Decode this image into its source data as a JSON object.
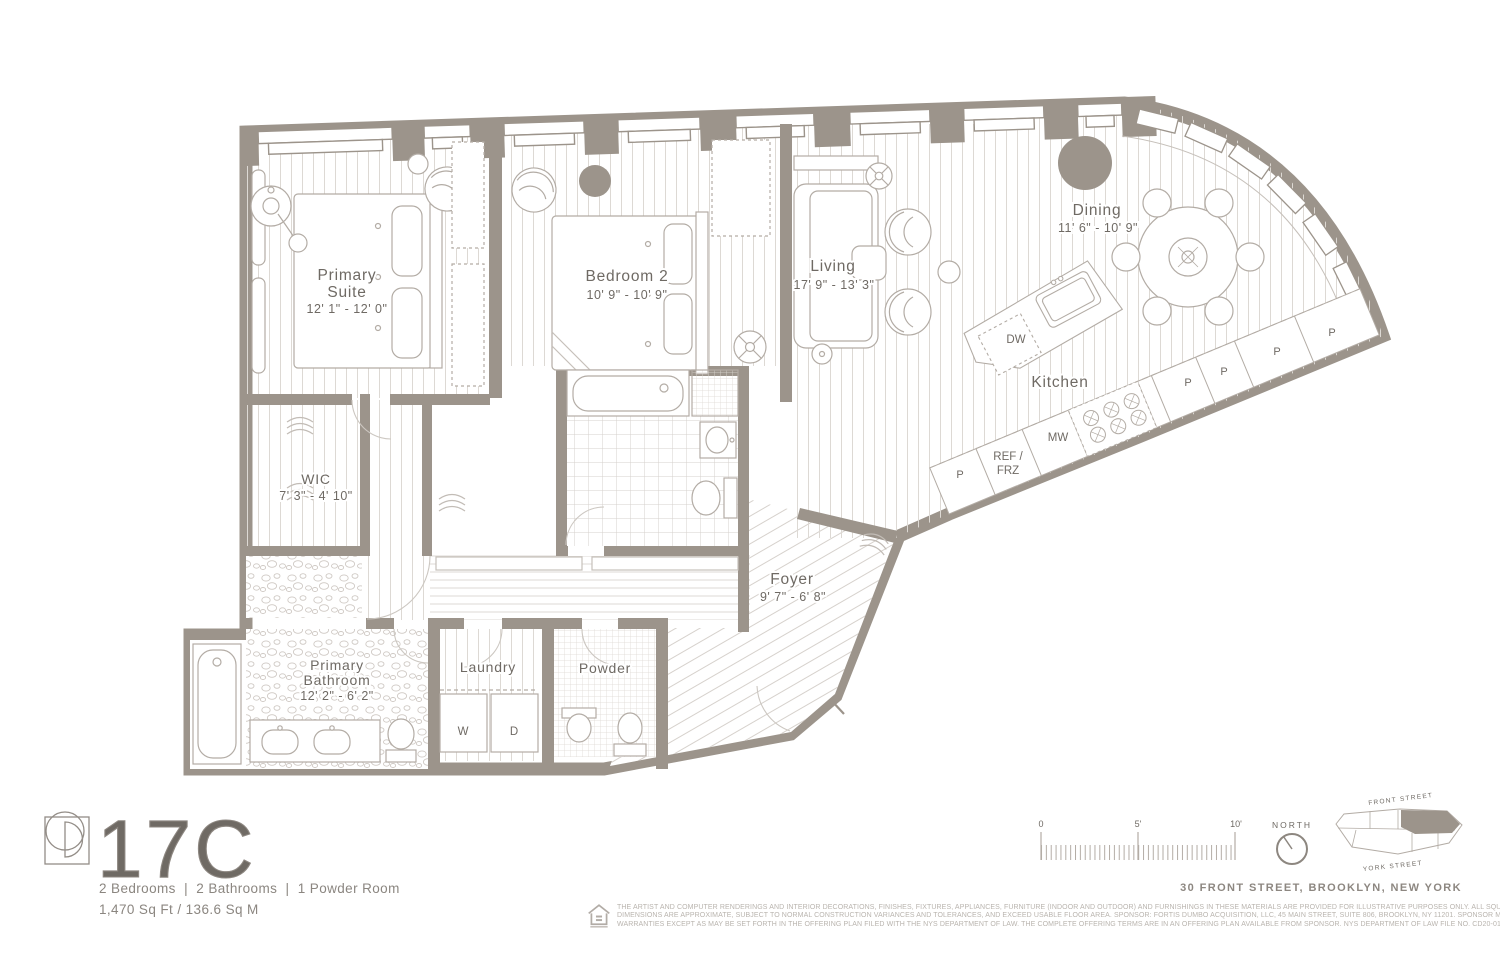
{
  "unit": {
    "name": "17C",
    "summary": "2 Bedrooms  |  2 Bathrooms  |  1 Powder Room",
    "area": "1,470 Sq Ft / 136.6 Sq M"
  },
  "rooms": {
    "primary_suite": {
      "line1": "Primary",
      "line2": "Suite",
      "dims": "12' 1\" - 12' 0\""
    },
    "bedroom2": {
      "name": "Bedroom 2",
      "dims": "10' 9\" - 10' 9\""
    },
    "living": {
      "name": "Living",
      "dims": "17' 9\" - 13' 3\""
    },
    "dining": {
      "name": "Dining",
      "dims": "11' 6\" - 10' 9\""
    },
    "kitchen": {
      "name": "Kitchen"
    },
    "wic": {
      "name": "WIC",
      "dims": "7' 3\" - 4' 10\""
    },
    "foyer": {
      "name": "Foyer",
      "dims": "9' 7\" - 6' 8\""
    },
    "primary_bathroom": {
      "line1": "Primary",
      "line2": "Bathroom",
      "dims": "12' 2\" - 6' 2\""
    },
    "laundry": {
      "name": "Laundry"
    },
    "powder": {
      "name": "Powder"
    }
  },
  "labels": {
    "dw": "DW",
    "mw": "MW",
    "ref_line1": "REF /",
    "ref_line2": "FRZ",
    "pantry": "P",
    "washer": "W",
    "dryer": "D"
  },
  "scale_bar": {
    "start": "0",
    "mid": "5'",
    "end": "10'"
  },
  "compass": {
    "label": "NORTH"
  },
  "minimap": {
    "street_top": "FRONT STREET",
    "street_bottom": "YORK STREET"
  },
  "address": "30 FRONT STREET, BROOKLYN, NEW YORK",
  "disclaimer": {
    "line1": "THE ARTIST AND COMPUTER RENDERINGS AND INTERIOR DECORATIONS, FINISHES, FIXTURES, APPLIANCES, FURNITURE (INDOOR AND OUTDOOR) AND FURNISHINGS IN THESE MATERIALS ARE PROVIDED FOR ILLUSTRATIVE PURPOSES ONLY. ALL SQUARE FOOTAGES AND",
    "line2": "DIMENSIONS ARE APPROXIMATE, SUBJECT TO NORMAL CONSTRUCTION VARIANCES AND TOLERANCES, AND EXCEED USABLE FLOOR AREA. SPONSOR: FORTIS DUMBO ACQUISITION, LLC, 45 MAIN STREET, SUITE 806, BROOKLYN, NY 11201. SPONSOR MAKES NO REPRESENTATION OR",
    "line3": "WARRANTIES EXCEPT AS MAY BE SET FORTH IN THE OFFERING PLAN FILED WITH THE NYS DEPARTMENT OF LAW. THE COMPLETE OFFERING TERMS ARE IN AN OFFERING PLAN AVAILABLE FROM SPONSOR. NYS DEPARTMENT OF LAW FILE NO. CD20-0174. EQUAL HOUSING OPPORTUNITY."
  },
  "colors": {
    "wall": "#9c948b",
    "hatch": "#ddd9d4",
    "furniture": "#b3aca5",
    "label": "#6f6a64"
  }
}
